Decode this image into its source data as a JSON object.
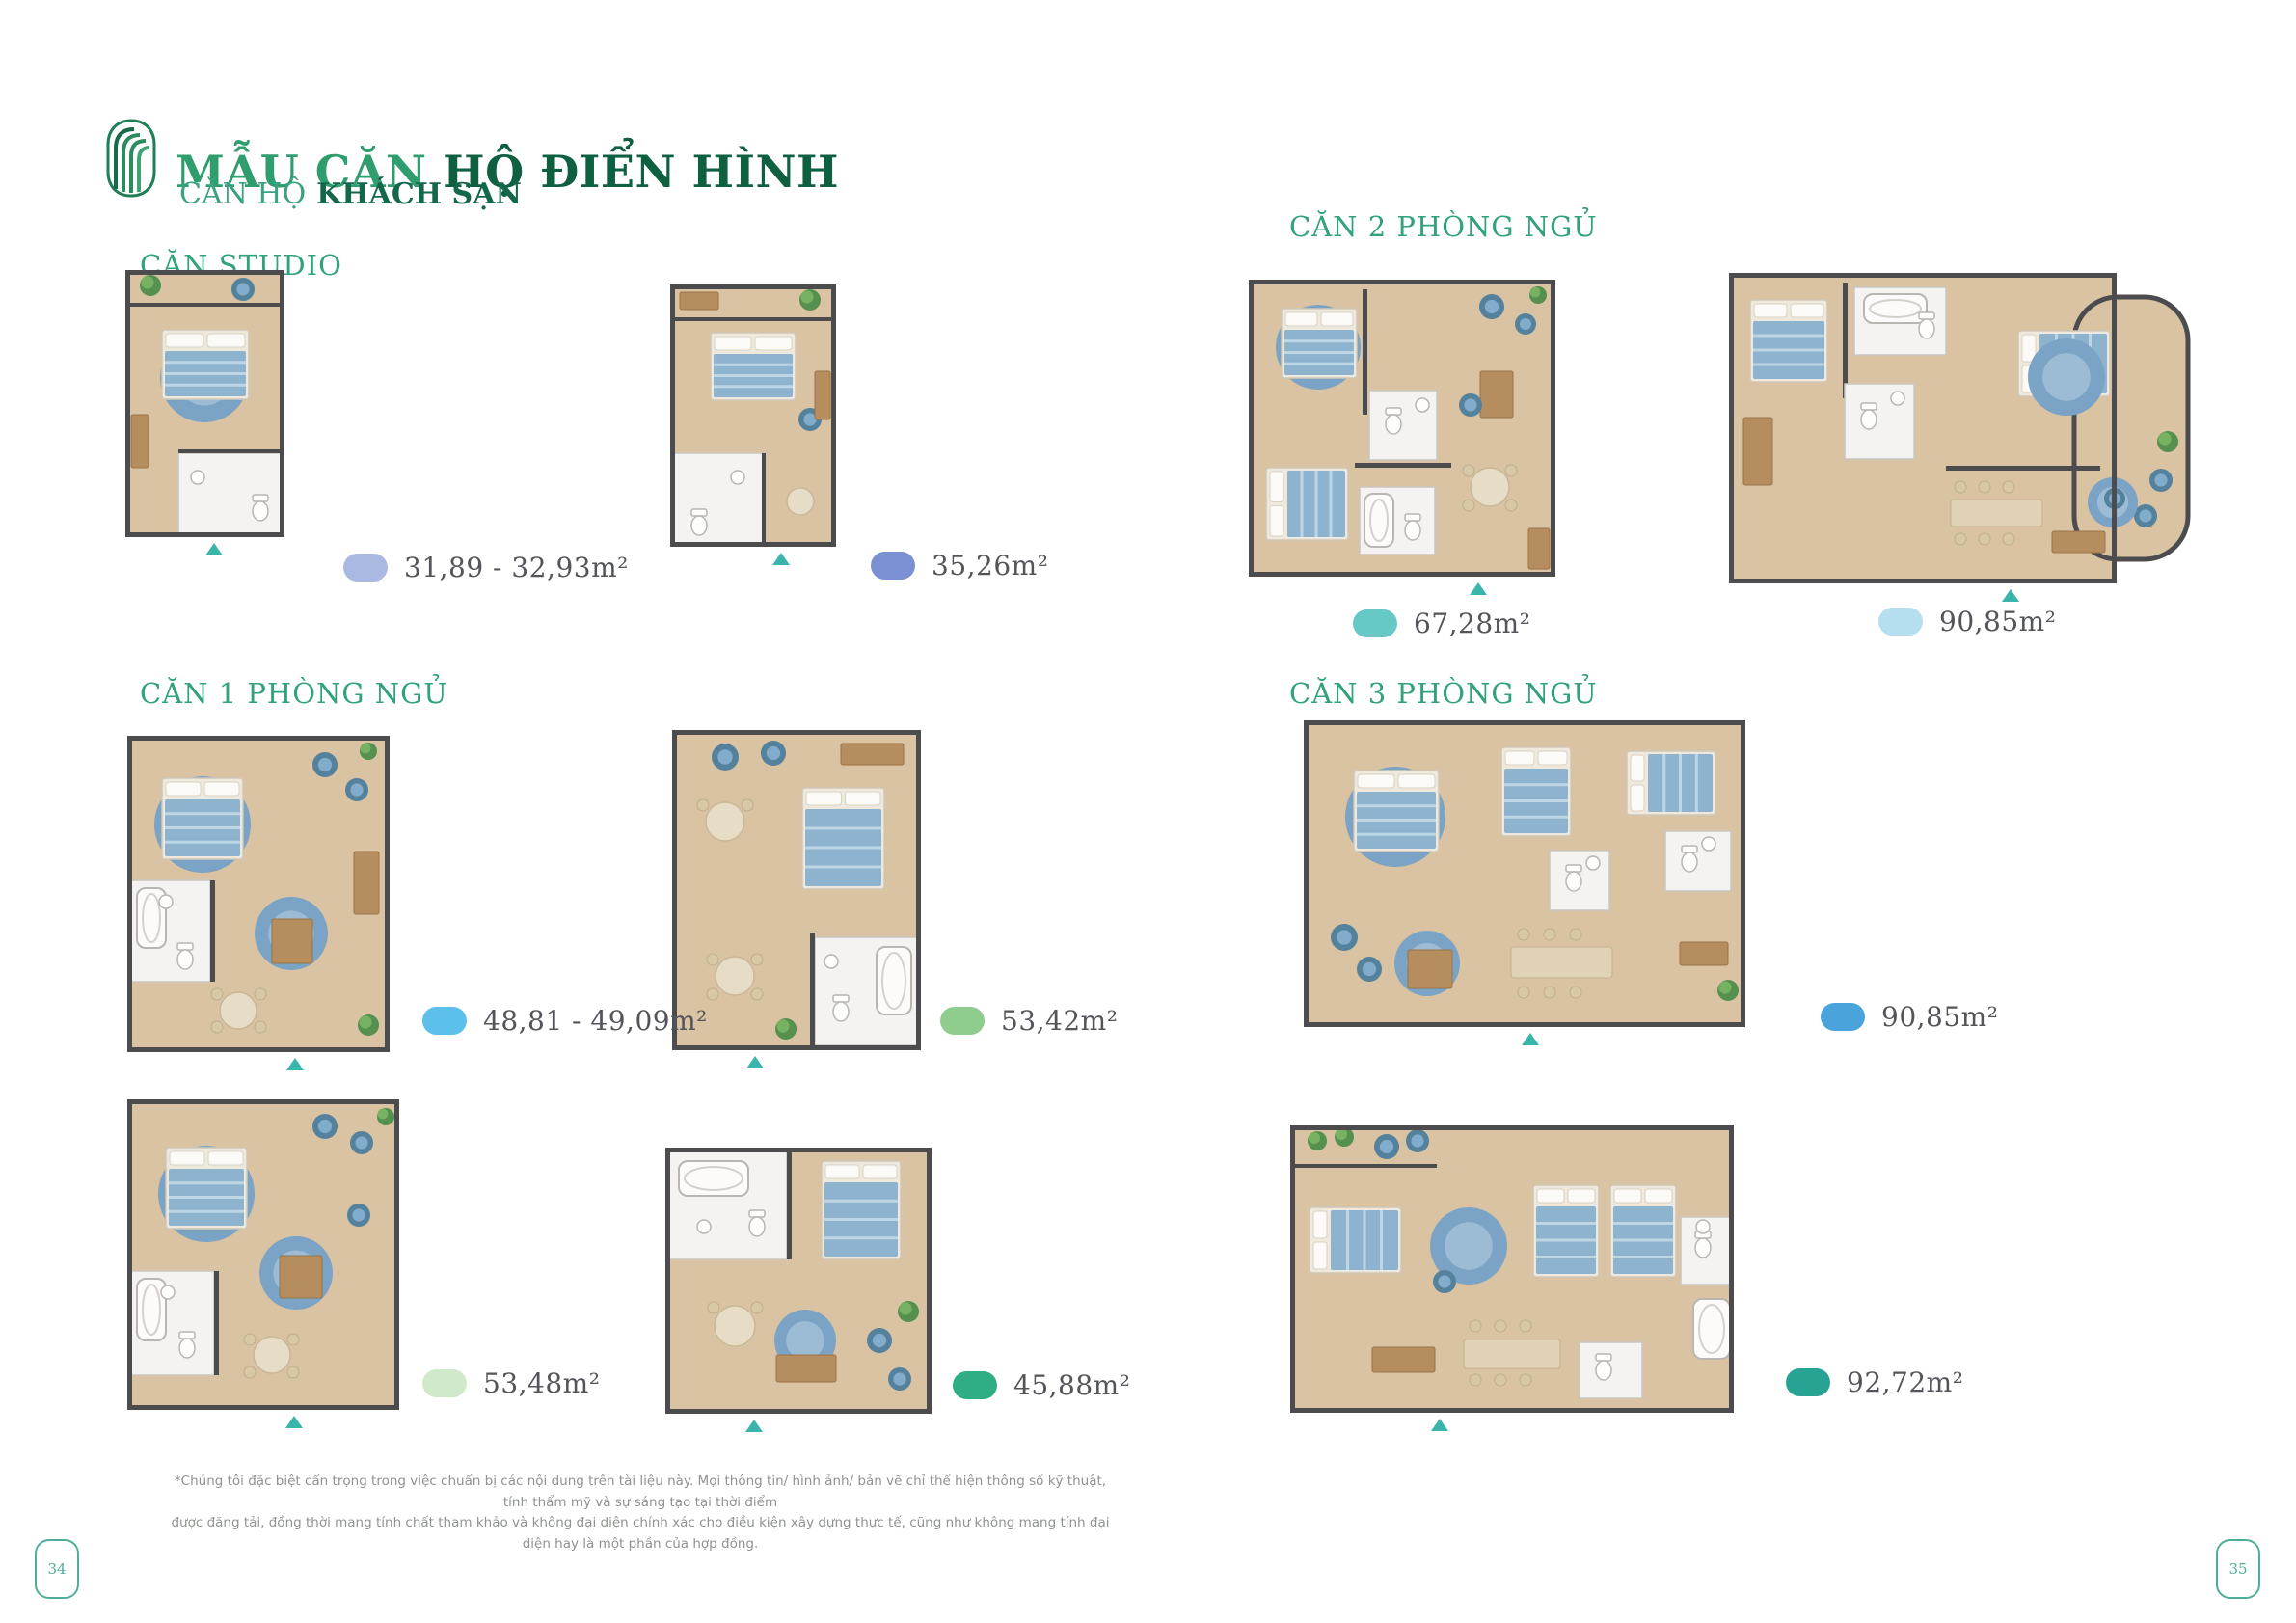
{
  "header": {
    "title_part1": "MẪU CĂN",
    "title_part2": " HỘ ĐIỂN HÌNH",
    "subtitle_light": "CĂN HỘ",
    "subtitle_bold": "KHÁCH SẠN"
  },
  "sections": [
    {
      "label": "CĂN STUDIO"
    },
    {
      "label": "CĂN 1 PHÒNG NGỦ"
    },
    {
      "label": "CĂN 2 PHÒNG NGỦ"
    },
    {
      "label": "CĂN 3 PHÒNG NGỦ"
    }
  ],
  "units": [
    {
      "section": "CĂN STUDIO",
      "area": "31,89 - 32,93m²",
      "color": "#aab9e2"
    },
    {
      "section": "CĂN STUDIO",
      "area": "35,26m²",
      "color": "#7b8fd3"
    },
    {
      "section": "CĂN 2 PHÒNG NGỦ",
      "area": "67,28m²",
      "color": "#66c9c5"
    },
    {
      "section": "CĂN 2 PHÒNG NGỦ",
      "area": "90,85m²",
      "color": "#b5dfee"
    },
    {
      "section": "CĂN 1 PHÒNG NGỦ",
      "area": "48,81 - 49,09m²",
      "color": "#5cc0ea"
    },
    {
      "section": "CĂN 1 PHÒNG NGỦ",
      "area": "53,42m²",
      "color": "#8ecd8d"
    },
    {
      "section": "CĂN 1 PHÒNG NGỦ",
      "area": "53,48m²",
      "color": "#cfe9ca"
    },
    {
      "section": "CĂN 1 PHÒNG NGỦ",
      "area": "45,88m²",
      "color": "#2fae85"
    },
    {
      "section": "CĂN 3 PHÒNG NGỦ",
      "area": "90,85m²",
      "color": "#4aa3da"
    },
    {
      "section": "CĂN 3 PHÒNG NGỦ",
      "area": "92,72m²",
      "color": "#27a394"
    }
  ],
  "footer": {
    "disclaimer_line1": "*Chúng tôi đặc biệt cẩn trọng trong việc chuẩn bị các nội dung trên tài liệu này. Mọi thông tin/ hình ảnh/ bản vẽ chỉ thể hiện thông số kỹ thuật, tính thẩm mỹ và sự sáng tạo tại thời điểm",
    "disclaimer_line2": "được đăng tải, đồng thời mang tính chất tham khảo và không đại diện chính xác cho điều kiện xây dựng thực tế, cũng như không mang tính đại diện hay là một phần của hợp đồng.",
    "page_number_left": "34",
    "page_number_right": "35"
  },
  "icons": {
    "logo": "brand-arch-stripes-logo",
    "entrance_arrow": "entrance-direction-arrow"
  },
  "colors": {
    "brand_green_dark": "#0f5f41",
    "brand_green": "#2f9d6e",
    "section_teal": "#31a27d",
    "arrow_teal": "#3ab5ac",
    "legend_text": "#53555a"
  }
}
